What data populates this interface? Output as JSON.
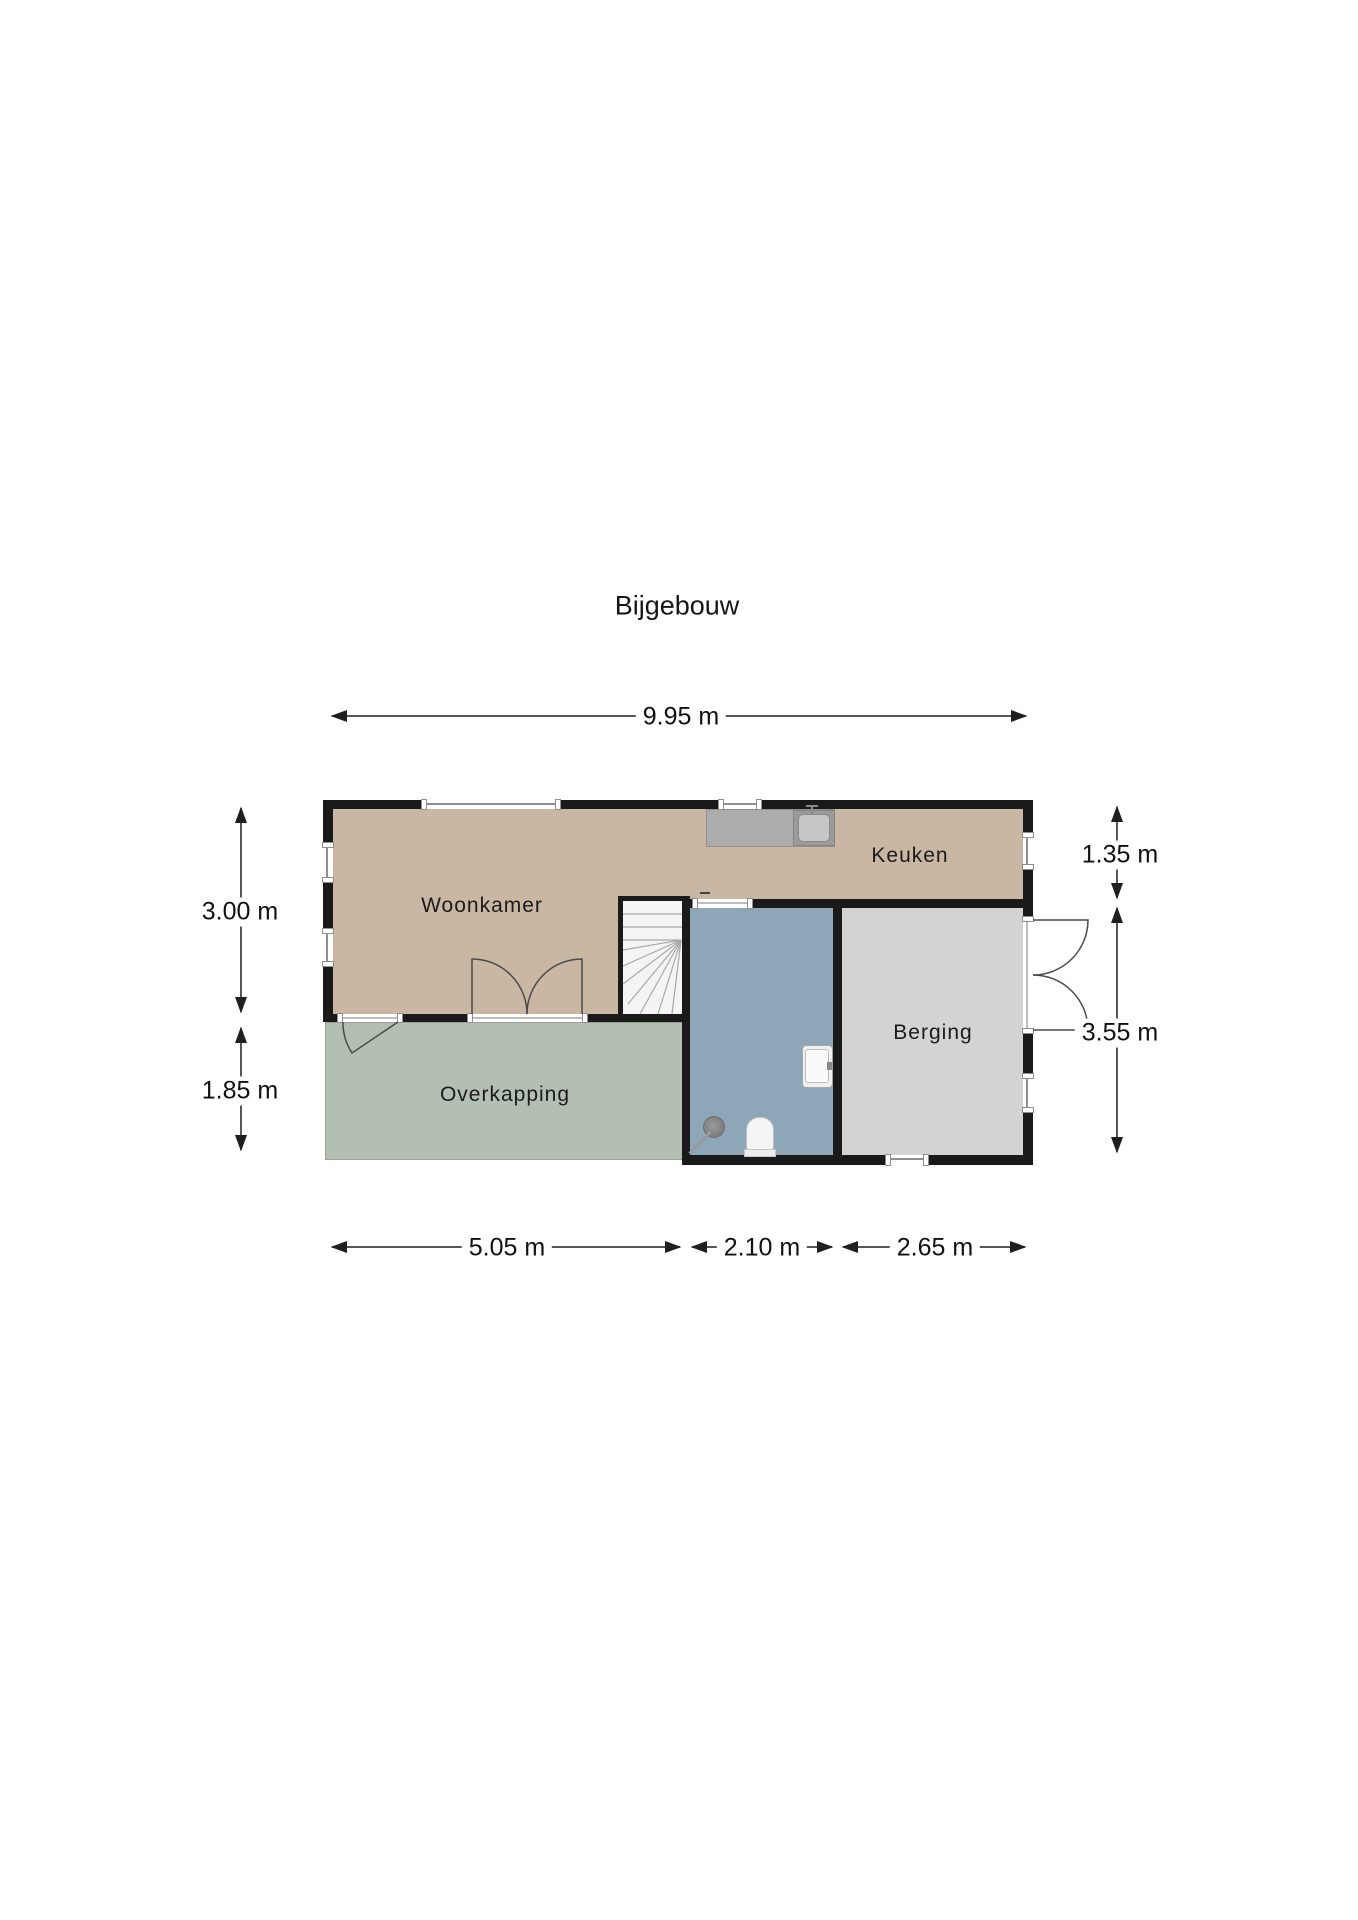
{
  "title": "Bijgebouw",
  "rooms": {
    "woonkamer": {
      "label": "Woonkamer"
    },
    "keuken": {
      "label": "Keuken"
    },
    "berging": {
      "label": "Berging"
    },
    "overkapping": {
      "label": "Overkapping"
    }
  },
  "dimensions": {
    "total_width": "9.95 m",
    "left_top": "3.00 m",
    "left_bottom": "1.85 m",
    "right_top": "1.35 m",
    "right_bottom": "3.55 m",
    "bottom_left": "5.05 m",
    "bottom_middle": "2.10 m",
    "bottom_right": "2.65 m"
  },
  "colors": {
    "floor_living": "#c9b7a4",
    "floor_overkapping": "#b4bfb3",
    "floor_bathroom": "#8ea7b8",
    "floor_berging": "#d3d3d3",
    "wall": "#1a1a1a",
    "counter": "#acacac",
    "stairs_bg": "#f4f4f4"
  }
}
